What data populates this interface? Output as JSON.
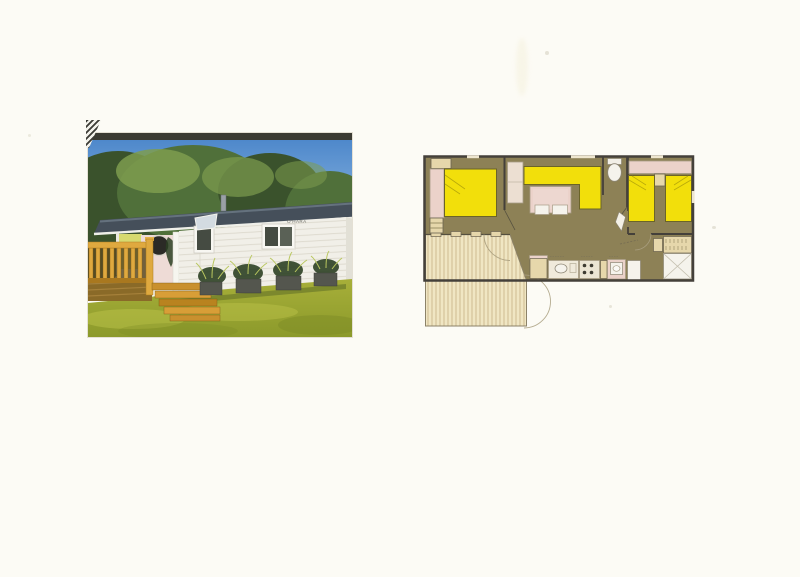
{
  "page": {
    "background": "#FCFBF5",
    "speck_color": "#C9C4B2"
  },
  "photo": {
    "subject": "mobile-home-exterior-photograph",
    "sign_text": "O'HARA",
    "sign_color": "#6F6F68",
    "colors": {
      "frame_strip": "#3B3B33",
      "sky_top": "#4E88CB",
      "sky_bottom": "#A8CBEA",
      "tree_dark": "#3A522C",
      "tree_mid": "#50703A",
      "tree_light": "#7E9C4F",
      "roof": "#454F5A",
      "roof_sheen": "#6E7B88",
      "chimney": "#9AA0A6",
      "wall": "#F1EFE8",
      "siding": "#DCD8CC",
      "gable": "#E2E0D6",
      "porch_yellow": "#D7DA6F",
      "porch_pink": "#EEDBD6",
      "porthole": "#2B2A26",
      "post": "#F6F5EF",
      "window_frame": "#F8F7F2",
      "window_dark": "#454B42",
      "window_dark2": "#5A6156",
      "pane_open": "#D3DBE1",
      "rail_wood": "#DFA93F",
      "rail_dark": "#A9781F",
      "deck_shadow": "#5B4A22",
      "step1": "#C9902E",
      "step2": "#D89E37",
      "step3": "#B9831F",
      "grass_top": "#A7AF39",
      "grass_bottom": "#8C9A2B",
      "grass_light": "#C2C84E",
      "grass_dark": "#7E8C26",
      "house_shadow": "#76832B",
      "planter": "#54564E",
      "foliage": "#2C4023",
      "blade": "#B9C75F"
    }
  },
  "floorplan": {
    "subject": "mobile-home-floor-plan",
    "rooms": [
      "double-bedroom",
      "living-room",
      "wc",
      "twin-bedroom",
      "bathroom",
      "kitchen",
      "deck-terrace"
    ],
    "colors": {
      "wall": "#44403A",
      "floor": "#8D8156",
      "bed": "#F2DF0B",
      "bed_edge": "#6B6428",
      "crease": "#B8A90A",
      "pink": "#EBD2CA",
      "cabinet": "#E6D7AB",
      "cabinet_line": "#8A7F57",
      "deck": "#F0E6C3",
      "deck_stripe": "#CBB78A",
      "deck_edge": "#8C8268",
      "white": "#F5F3EC",
      "outline": "#55503F",
      "soft": "#A79C86",
      "arc": "#A89D7E",
      "window": "#EEE6CF",
      "burner": "#3E3B32"
    }
  }
}
